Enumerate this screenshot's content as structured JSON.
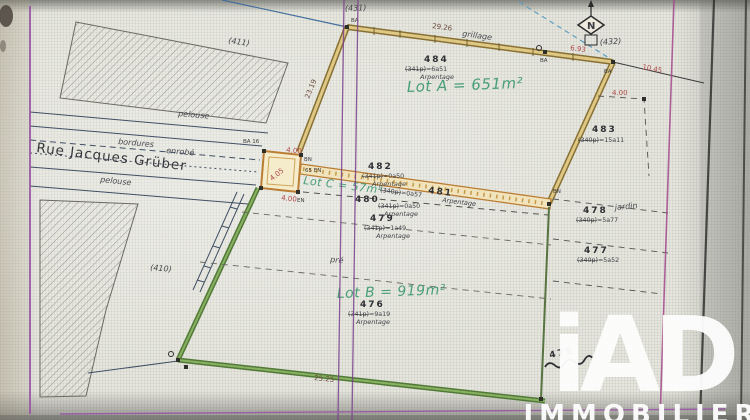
{
  "plan": {
    "street_name": "Rue Jacques Grüber",
    "surfaces": {
      "pelouse_top": "pelouse",
      "pelouse_bottom": "pelouse",
      "enrobe": "enrobé",
      "bordures": "bordures",
      "pre": "pré",
      "jardin": "jardin",
      "grillage": "grillage"
    },
    "lots": {
      "a": "Lot A = 651m²",
      "b": "Lot B = 919m²",
      "c": "Lot C = 57m²"
    },
    "parcels": {
      "p484": {
        "num": "484",
        "old": "(341p)",
        "area": "=6a51",
        "note": "Arpentage"
      },
      "p483": {
        "num": "483",
        "old": "(340p)",
        "area": "=15a11"
      },
      "p482": {
        "num": "482",
        "old": "(341p)",
        "area": "=0a50",
        "note": "Arpentage"
      },
      "p481": {
        "num": "481",
        "old": "(340p)",
        "area": "=0a57",
        "note": "Arpentage"
      },
      "p480": {
        "num": "480",
        "old": "(341p)",
        "area": "=0a50",
        "note": "Arpentage"
      },
      "p479": {
        "num": "479",
        "old": "(341p)",
        "area": "=1a49",
        "note": "Arpentage"
      },
      "p478": {
        "num": "478",
        "old": "(340p)",
        "area": "=5a77"
      },
      "p477": {
        "num": "477",
        "old": "(340p)",
        "area": "=5a52"
      },
      "p476": {
        "num": "476",
        "old": "(341p)",
        "area": "=9a19",
        "note": "Arpentage"
      },
      "p475": {
        "num": "475"
      }
    },
    "context": {
      "c431": "(431)",
      "c432": "(432)",
      "c411": "(411)",
      "c410": "(410)"
    },
    "measurements": {
      "top_fence": "29.26",
      "m693": "6.93",
      "m1045": "10.45",
      "m400_right": "4.00",
      "m2319": "23.19",
      "sq_top": "4.00",
      "sq_diag": "4.05",
      "sq_bottom": "4.00",
      "bottom": "25.25"
    },
    "markers": {
      "ba_nw": "BA",
      "ba_mid": "BA",
      "ba_ne": "BA",
      "ba16": "BA 16",
      "bn": "BN",
      "en65": "65 EN",
      "en_s": "EN",
      "bn_e": "BN"
    },
    "north_letter": "N"
  },
  "watermark": {
    "brand": "iAD",
    "subtitle": "IMMOBILIER"
  },
  "colors": {
    "lot_a_boundary": "#c2a24e",
    "lot_c_boundary": "#bf7c2c",
    "lot_b_boundary": "#4f7a33",
    "lot_text_green": "#44a074",
    "measurement_red": "#b84848",
    "photo_line_purple": "#8a46a0",
    "photo_line_magenta": "#aa4790"
  }
}
